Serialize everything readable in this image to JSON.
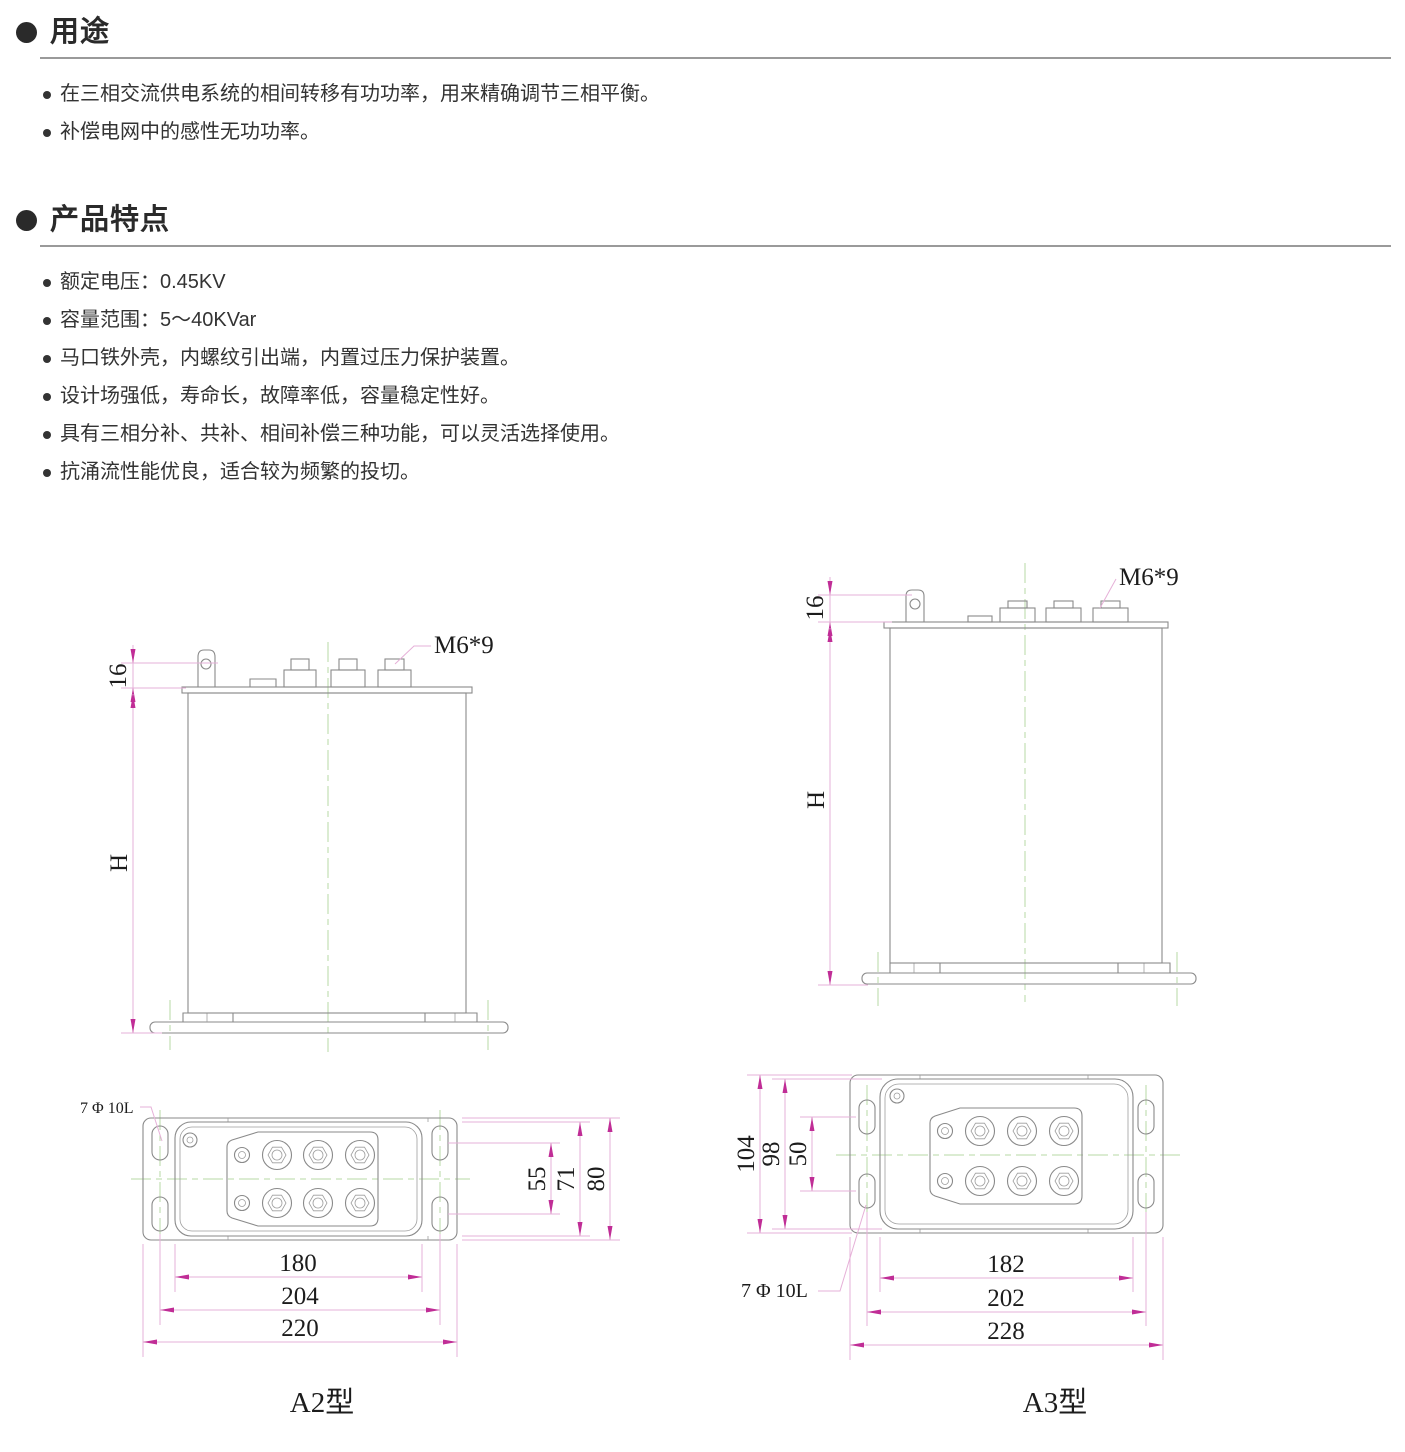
{
  "doc": {
    "sections": [
      {
        "title": "用途",
        "bullets": [
          "在三相交流供电系统的相间转移有功功率，用来精确调节三相平衡。",
          "补偿电网中的感性无功功率。"
        ]
      },
      {
        "title": "产品特点",
        "bullets": [
          "额定电压：0.45KV",
          "容量范围：5～40KVar",
          "马口铁外壳，内螺纹引出端，内置过压力保护装置。",
          "设计场强低，寿命长，故障率低，容量稳定性好。",
          "具有三相分补、共补、相间补偿三种功能，可以灵活选择使用。",
          "抗涌流性能优良，适合较为频繁的投切。"
        ]
      }
    ]
  },
  "drawings": {
    "a2": {
      "caption": "A2型",
      "thread_label": "M6*9",
      "hole_label": "7 Φ 10L",
      "dims": {
        "top_offset": "16",
        "height": "H",
        "slot_span_v": "55",
        "body_v": "71",
        "plate_v": "80",
        "body_w": "180",
        "slot_span_w": "204",
        "plate_w": "220"
      }
    },
    "a3": {
      "caption": "A3型",
      "thread_label": "M6*9",
      "hole_label": "7 Φ 10L",
      "dims": {
        "top_offset": "16",
        "height": "H",
        "slot_span_v": "50",
        "body_v": "98",
        "plate_v": "104",
        "body_w": "182",
        "slot_span_w": "202",
        "plate_w": "228"
      }
    }
  },
  "colors": {
    "dimension_line": "#e6b0d8",
    "dimension_arrow": "#c02d96",
    "outline": "#8a8a8a",
    "centerline": "#b7d9a6",
    "text": "#1c1c1c",
    "heading": "#2a2a2a",
    "rule": "#9a9a9a"
  }
}
